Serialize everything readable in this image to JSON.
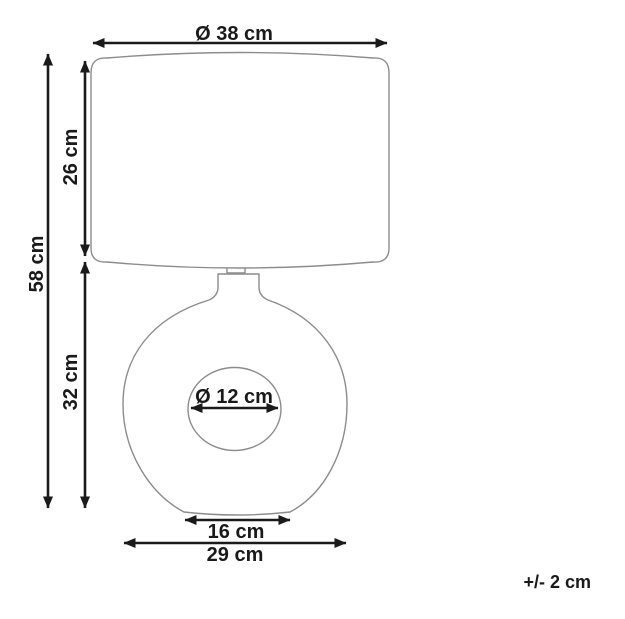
{
  "page": {
    "background": "#ffffff"
  },
  "colors": {
    "product_outline": "#8c8c8c",
    "dimension_ink": "#1a1a1a"
  },
  "diagram": {
    "kind": "product-dimension-drawing",
    "product": "table-lamp",
    "labels": {
      "shade_diameter": "Ø 38 cm",
      "total_height": "58 cm",
      "shade_height": "26 cm",
      "base_height": "32 cm",
      "hole_diameter": "Ø 12 cm",
      "foot_width": "16 cm",
      "base_width": "29 cm",
      "tolerance": "+/- 2 cm"
    },
    "values_cm": {
      "shade_diameter": 38,
      "total_height": 58,
      "shade_height": 26,
      "base_height": 32,
      "hole_diameter": 12,
      "foot_width": 16,
      "base_width": 29,
      "tolerance_plus_minus": 2
    }
  }
}
